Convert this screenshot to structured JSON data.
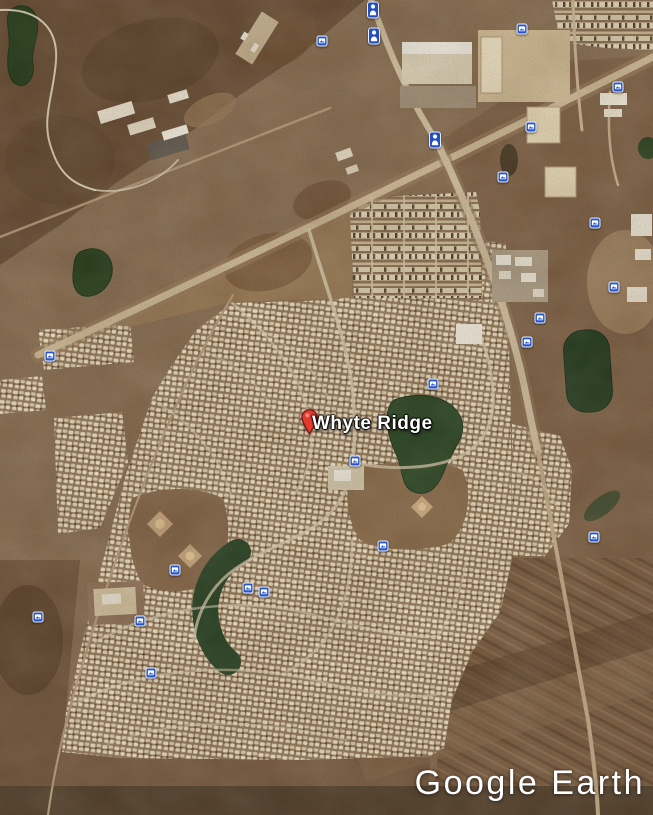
{
  "branding": {
    "watermark": "Google Earth"
  },
  "map": {
    "place_label": "Whyte Ridge",
    "pin_color": "#e23b2e",
    "poi_icon_color": "#2856c8",
    "pois": [
      {
        "type": "person",
        "x": 373,
        "y": 10
      },
      {
        "type": "person",
        "x": 374,
        "y": 36
      },
      {
        "type": "photo",
        "x": 322,
        "y": 41
      },
      {
        "type": "photo",
        "x": 522,
        "y": 29
      },
      {
        "type": "photo",
        "x": 618,
        "y": 87
      },
      {
        "type": "photo",
        "x": 531,
        "y": 127
      },
      {
        "type": "person",
        "x": 435,
        "y": 140
      },
      {
        "type": "photo",
        "x": 503,
        "y": 177
      },
      {
        "type": "photo",
        "x": 595,
        "y": 223
      },
      {
        "type": "photo",
        "x": 614,
        "y": 287
      },
      {
        "type": "photo",
        "x": 540,
        "y": 318
      },
      {
        "type": "photo",
        "x": 527,
        "y": 342
      },
      {
        "type": "photo",
        "x": 50,
        "y": 356
      },
      {
        "type": "photo",
        "x": 433,
        "y": 384
      },
      {
        "type": "photo",
        "x": 355,
        "y": 461
      },
      {
        "type": "photo",
        "x": 383,
        "y": 546
      },
      {
        "type": "photo",
        "x": 175,
        "y": 570
      },
      {
        "type": "photo",
        "x": 248,
        "y": 588
      },
      {
        "type": "photo",
        "x": 264,
        "y": 592
      },
      {
        "type": "photo",
        "x": 38,
        "y": 617
      },
      {
        "type": "photo",
        "x": 140,
        "y": 621
      },
      {
        "type": "photo",
        "x": 151,
        "y": 673
      },
      {
        "type": "photo",
        "x": 594,
        "y": 537
      }
    ]
  },
  "palette": {
    "earth_base": "#8a6f52",
    "scrub_dark": "#6b4f36",
    "residential_cream": "#eee1c4",
    "pond_green": "#2d4626",
    "road_tan": "#d3c0a0",
    "field_stripe": "#6c4e34",
    "poi_blue": "#2856c8",
    "pin_red": "#e23b2e",
    "label_white": "#ffffff"
  }
}
